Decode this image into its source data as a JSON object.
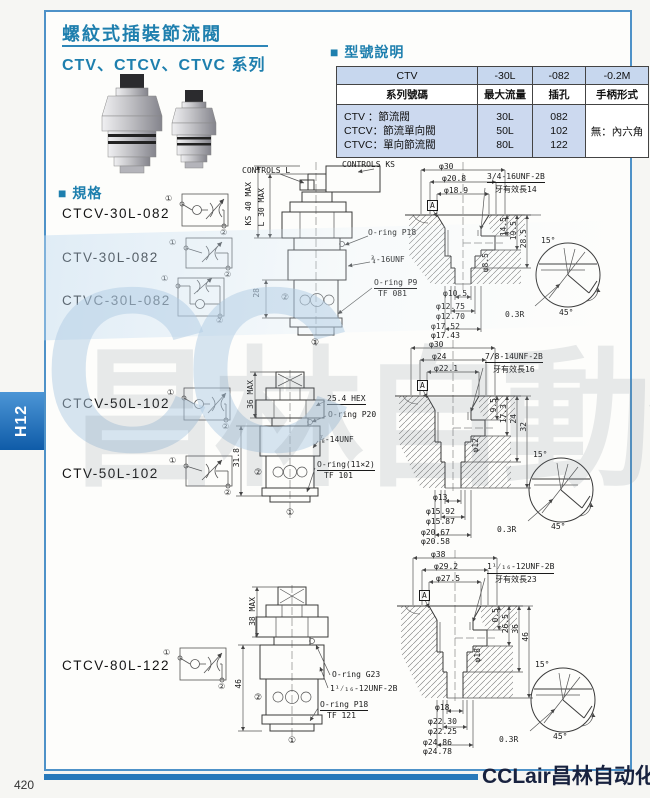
{
  "page": {
    "tab": "H12",
    "page_number": "420",
    "logo_en": "CCLair",
    "logo_cn": "昌林自动化",
    "watermark_cc": "CC",
    "watermark_cn": "昌林自動化"
  },
  "header": {
    "title": "螺紋式插裝節流閥",
    "subtitle": "CTV、CTCV、CTVC 系列"
  },
  "model_section": {
    "heading": "■ 型號說明",
    "table": {
      "code_row": [
        "CTV",
        "-30L",
        "-082",
        "-0.2M"
      ],
      "label_row": [
        "系列號碼",
        "最大流量",
        "插孔",
        "手柄形式"
      ],
      "series": [
        "CTV ：節流閥",
        "CTCV：節流單向閥",
        "CTVC：單向節流閥"
      ],
      "flows": [
        "30L",
        "50L",
        "80L"
      ],
      "holes": [
        "082",
        "102",
        "122"
      ],
      "handle": "無：內六角"
    }
  },
  "spec_section": {
    "heading": "■ 規格",
    "models": [
      "CTCV-30L-082",
      "CTV-30L-082",
      "CTVC-30L-082",
      "CTCV-50L-102",
      "CTV-50L-102",
      "CTCV-80L-122"
    ]
  },
  "sym": {
    "p1": "①",
    "p2": "②"
  },
  "d30": {
    "valve": {
      "controls_l": "CONTROLS L",
      "controls_ks": "CONTROLS KS",
      "dim1": "KS 40 MAX",
      "dim2": "L 30 MAX",
      "dim3": "28",
      "note1": "O-ring P18",
      "note2": "¾-16UNF",
      "note3": "O-ring P9",
      "note4": "TF 081"
    },
    "cavity": {
      "dia1": "φ30",
      "dia2": "φ20.8",
      "dia3": "φ18.9",
      "datum": "A",
      "thread": "3/4-16UNF-2B",
      "thread_len": "牙有效長14",
      "v1": "14.5",
      "v2": "19.5",
      "v3": "28.5",
      "bore": "φ8.5",
      "b1": "φ10.5",
      "b2": "φ12.75",
      "b3": "φ12.70",
      "b4": "φ17.52",
      "b5": "φ17.43",
      "ang": "15°",
      "rad": "0.3R",
      "cham": "45°"
    }
  },
  "d50": {
    "valve": {
      "dim1": "36 MAX",
      "dim2": "31.8",
      "hex": "25.4 HEX",
      "note1": "O-ring P20",
      "note2": "⅞-14UNF",
      "note3": "O-ring(11×2)",
      "note4": "TF 101"
    },
    "cavity": {
      "dia1": "φ30",
      "dia2": "φ24",
      "dia3": "φ22.1",
      "datum": "A",
      "thread": "7/8-14UNF-2B",
      "thread_len": "牙有效長16",
      "v1": "9.5",
      "v2": "17.3",
      "v3": "24",
      "v4": "32",
      "bore": "φ12",
      "b1": "φ13",
      "b2": "φ15.92",
      "b3": "φ15.87",
      "b4": "φ20.67",
      "b5": "φ20.58",
      "ang": "15°",
      "rad": "0.3R",
      "cham": "45°"
    }
  },
  "d80": {
    "valve": {
      "dim1": "38 MAX",
      "dim2": "46",
      "note1": "O-ring G23",
      "note2": "1¹⁄₁₆-12UNF-2B",
      "note3": "O-ring P18",
      "note4": "TF 121"
    },
    "cavity": {
      "dia1": "φ38",
      "dia2": "φ29.2",
      "dia3": "φ27.5",
      "datum": "A",
      "thread": "1¹⁄₁₆-12UNF-2B",
      "thread_len": "牙有效長23",
      "v1": "0.5",
      "v2": "26.5",
      "v3": "36",
      "v4": "46",
      "bore": "φ18",
      "b1": "φ18",
      "b2": "φ22.30",
      "b3": "φ22.25",
      "b4": "φ24.86",
      "b5": "φ24.78",
      "ang": "15°",
      "rad": "0.3R",
      "cham": "45°"
    }
  }
}
